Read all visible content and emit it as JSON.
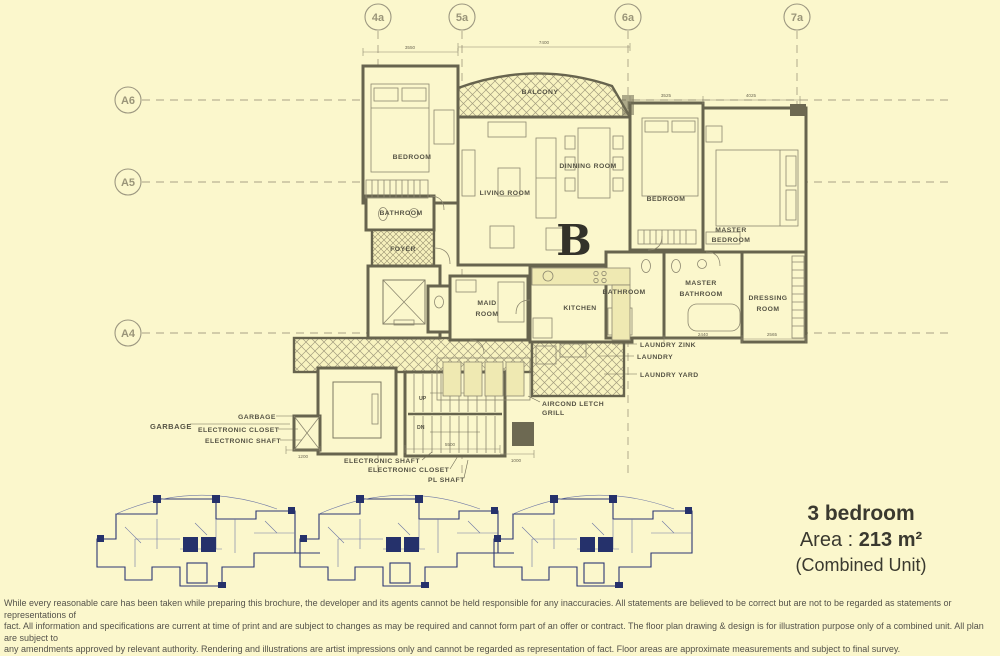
{
  "colors": {
    "background": "#FBF7CC",
    "plan_ink": "#67644E",
    "hatch_ink": "#A29C7E",
    "keyplan_ink": "#25316B",
    "text_dark": "#3A392F"
  },
  "grid": {
    "top": [
      "4a",
      "5a",
      "6a",
      "7a"
    ],
    "left": [
      "A6",
      "A5",
      "A4"
    ]
  },
  "plan": {
    "unit_letter": "B",
    "labels": {
      "bedroom1": "BEDROOM",
      "balcony": "BALCONY",
      "living_room": "LIVING ROOM",
      "dinning_room": "DINNING ROOM",
      "bathroom": "BATHROOM",
      "foyer": "FOYER",
      "bedroom2": "BEDROOM",
      "master_bedroom": [
        "MASTER",
        "BEDROOM"
      ],
      "bathroom2": "BATHROOM",
      "master_bathroom": [
        "MASTER",
        "BATHROOM"
      ],
      "dressing_room": [
        "DRESSING",
        "ROOM"
      ],
      "kitchen": "KITCHEN",
      "maid_room": [
        "MAID",
        "ROOM"
      ],
      "laundry_zink": "LAUNDRY ZINK",
      "laundry": "LAUNDRY",
      "laundry_yard": "LAUNDRY YARD",
      "aircond": [
        "AIRCOND LETCH",
        "GRILL"
      ],
      "up": "UP",
      "dn": "DN",
      "garbage_left": "GARBAGE",
      "garbage": "GARBAGE",
      "electronic_closet_top": "ELECTRONIC CLOSET",
      "electronic_shaft_top": "ELECTRONIC SHAFT",
      "electronic_shaft_bottom": "ELECTRONIC SHAFT",
      "electronic_closet_bottom": "ELECTRONIC CLOSET",
      "pl_shaft": "PL SHAFT"
    },
    "dimensions": {
      "d3550": "3550",
      "d7400": "7400",
      "d3525": "3525",
      "d4025": "4025",
      "d2440": "2440",
      "d2565": "2565",
      "d1200": "1200",
      "d5500": "5500",
      "d1000": "1000"
    }
  },
  "unit_info": {
    "type": "3 bedroom",
    "area_label": "Area :",
    "area_value": "213 m²",
    "combined": "(Combined Unit)"
  },
  "disclaimer": {
    "line1": "While every reasonable care has been taken while preparing this brochure, the developer and its agents cannot be held responsible for any inaccuracies. All statements are believed to be correct but are not to be regarded as statements or representations of",
    "line2": "fact. All information and specifications are current at time of print and are subject to changes as may be required and cannot form part of an offer or contract. The floor plan drawing & design is for illustration purpose only of a combined unit. All plan are subject to",
    "line3": "any amendments approved by relevant authority. Rendering and illustrations are artist impressions only and cannot be regarded as representation of fact. Floor areas are approximate measurements and subject to final survey."
  }
}
